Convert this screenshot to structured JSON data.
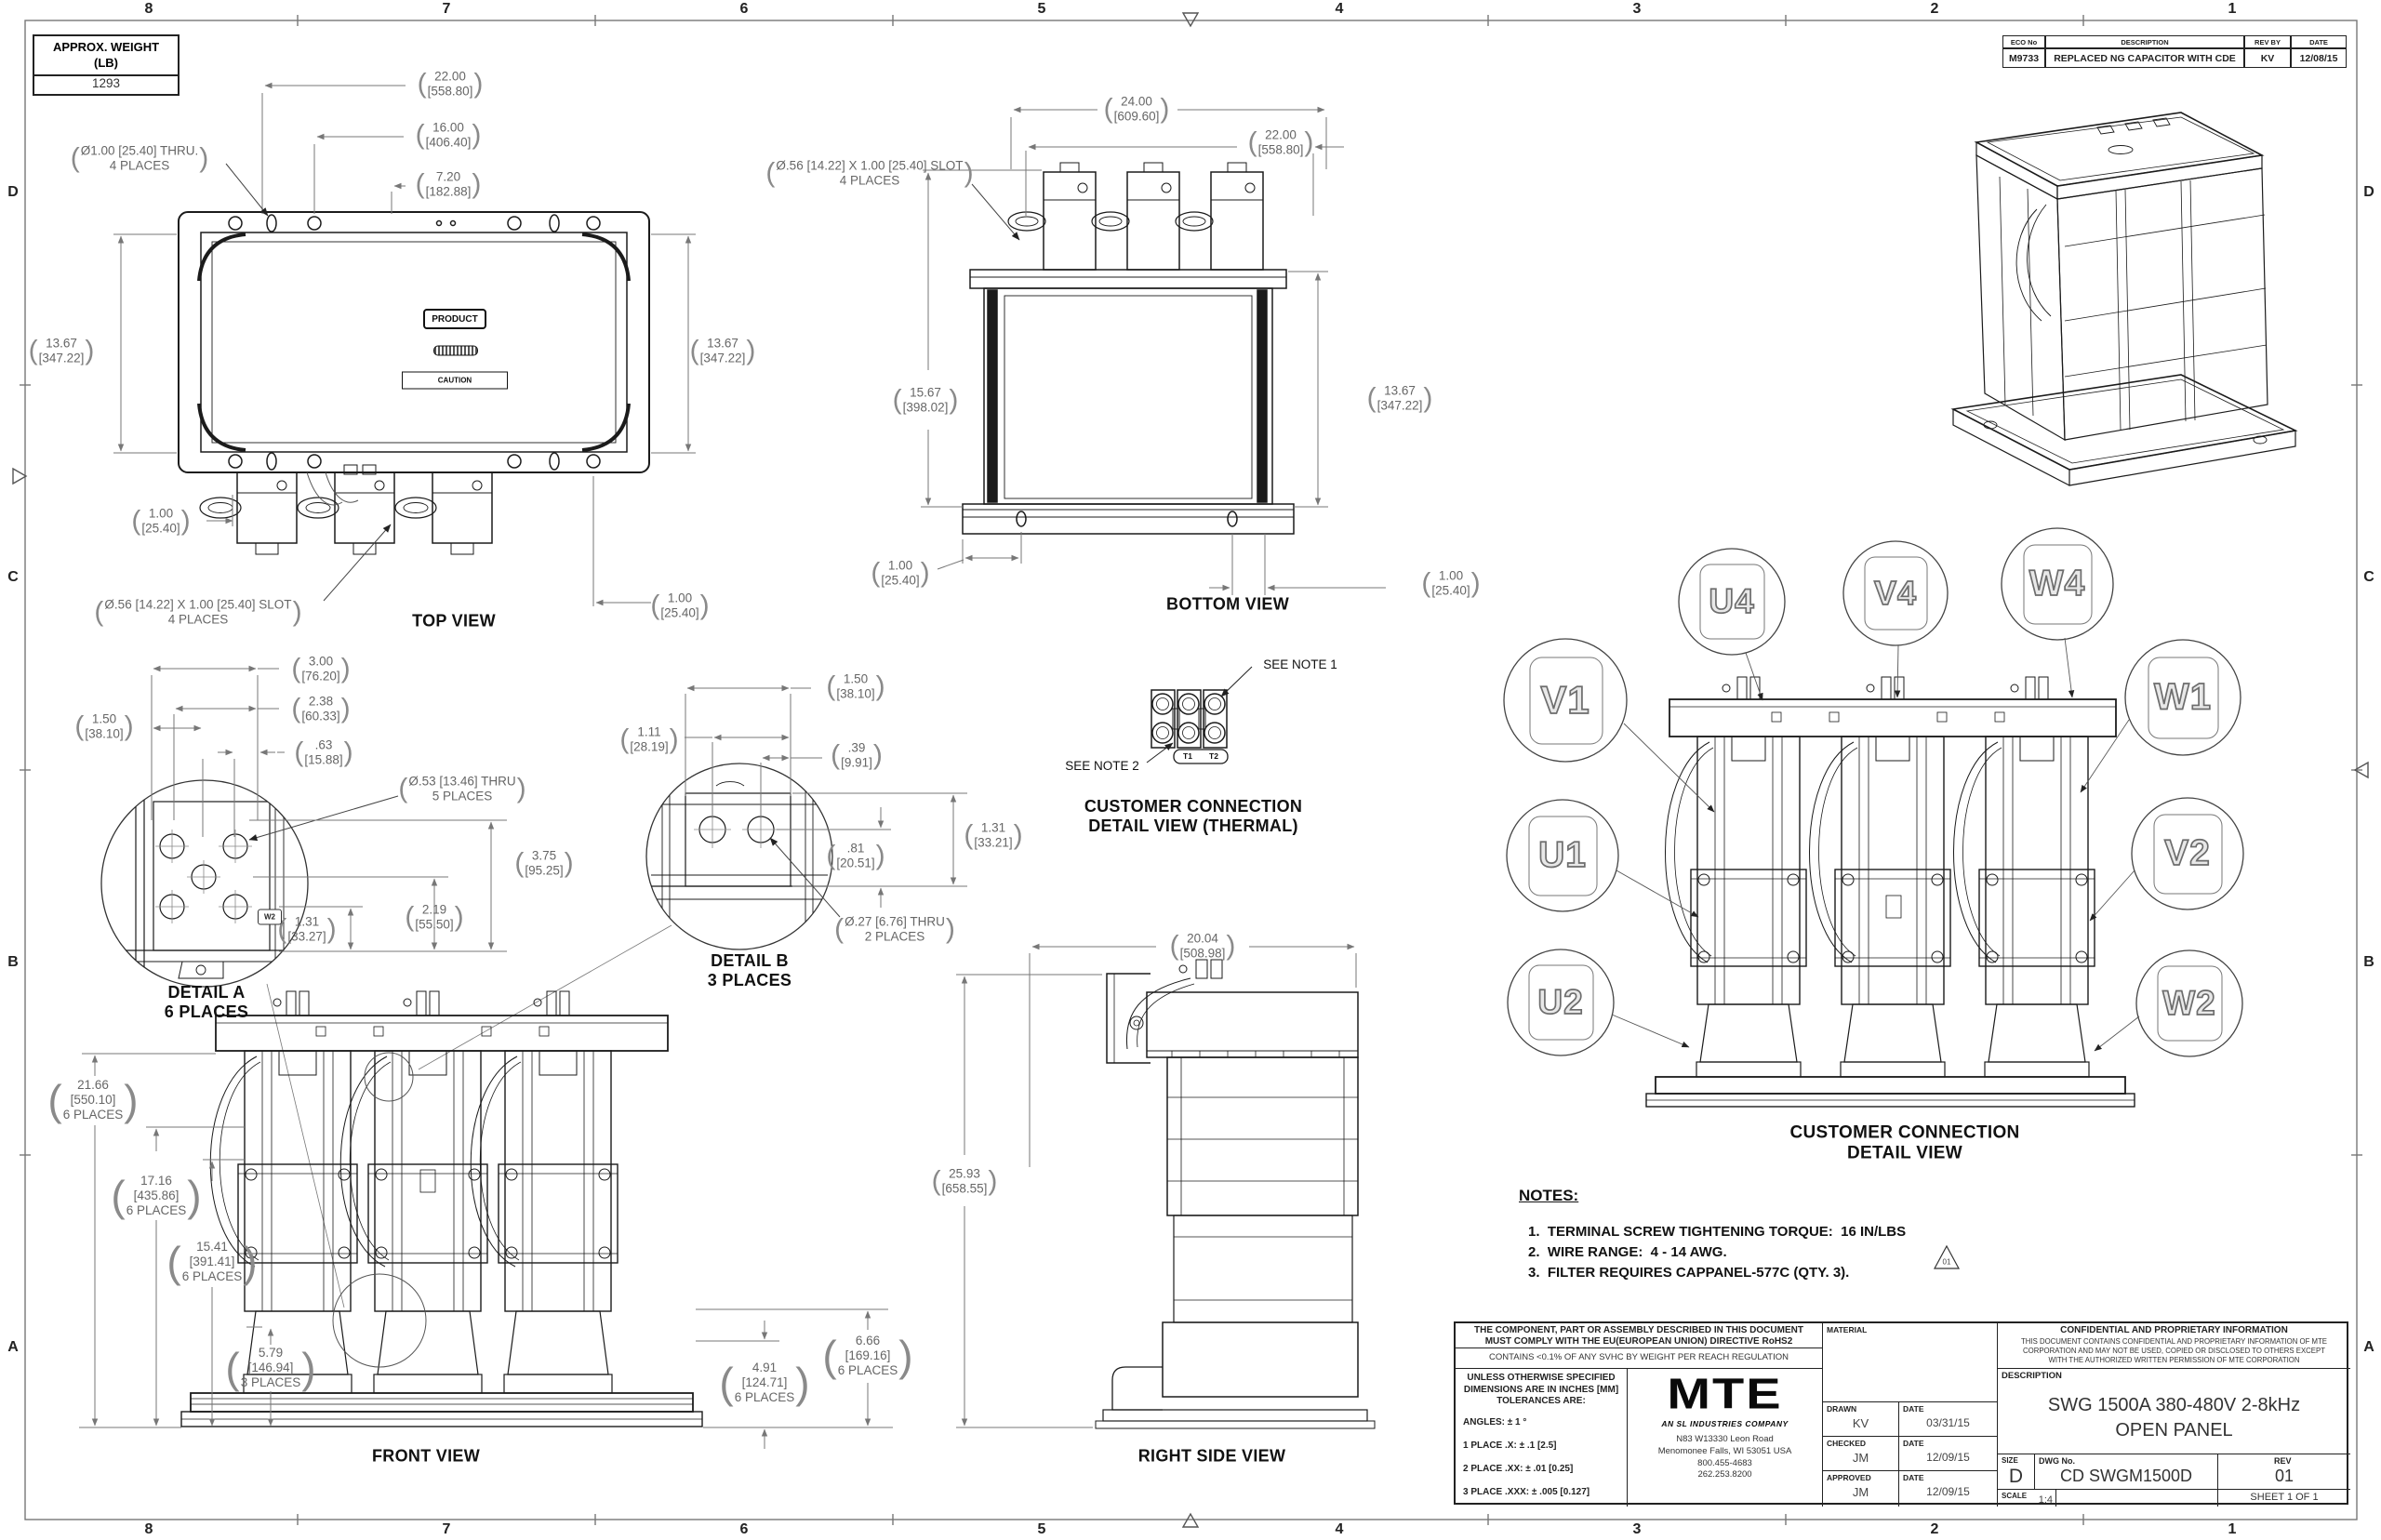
{
  "zones": {
    "columns": [
      "8",
      "7",
      "6",
      "5",
      "4",
      "3",
      "2",
      "1"
    ],
    "rows": [
      "D",
      "C",
      "B",
      "A"
    ]
  },
  "weight_box": {
    "label": "APPROX. WEIGHT\n(LB)",
    "value": "1293"
  },
  "eco_table": {
    "headers": [
      "ECO No",
      "DESCRIPTION",
      "REV BY",
      "DATE"
    ],
    "row": [
      "M9733",
      "REPLACED NG CAPACITOR WITH CDE",
      "KV",
      "12/08/15"
    ]
  },
  "views": {
    "top": {
      "title": "TOP VIEW",
      "product_label": "PRODUCT",
      "caution_label": "CAUTION",
      "dims": {
        "width": "22.00\n[558.80]",
        "width_inner": "16.00\n[406.40]",
        "width_small": "7.20\n[182.88]",
        "hole_note": "Ø1.00 [25.40] THRU.\n4 PLACES",
        "height_left": "13.67\n[347.22]",
        "height_right": "13.67\n[347.22]",
        "offset_left": "1.00\n[25.40]",
        "offset_right": "1.00\n[25.40]",
        "slot_note": "Ø.56 [14.22] X 1.00 [25.40] SLOT\n4 PLACES"
      }
    },
    "bottom": {
      "title": "BOTTOM VIEW",
      "dims": {
        "width": "24.00\n[609.60]",
        "width_inner": "22.00\n[558.80]",
        "slot_note": "Ø.56 [14.22] X 1.00 [25.40] SLOT\n4 PLACES",
        "height_left": "15.67\n[398.02]",
        "height_right": "13.67\n[347.22]",
        "offset_left": "1.00\n[25.40]",
        "offset_right": "1.00\n[25.40]"
      }
    },
    "detail_a": {
      "title": "DETAIL A\n6 PLACES",
      "tag": "W2",
      "dims": {
        "d1": "1.50\n[38.10]",
        "d2": "3.00\n[76.20]",
        "d3": "2.38\n[60.33]",
        "d4": ".63\n[15.88]",
        "hole_note": "Ø.53 [13.46] THRU\n5 PLACES",
        "d5": "3.75\n[95.25]",
        "d6": "2.19\n[55.50]",
        "d7": "1.31\n[33.27]"
      }
    },
    "detail_b": {
      "title": "DETAIL B\n3 PLACES",
      "dims": {
        "d1": "1.50\n[38.10]",
        "d2": "1.11\n[28.19]",
        "d3": ".39\n[9.91]",
        "d4": ".81\n[20.51]",
        "d5": "1.31\n[33.21]",
        "hole_note": "Ø.27 [6.76] THRU\n2 PLACES"
      }
    },
    "thermal": {
      "title": "CUSTOMER CONNECTION\nDETAIL VIEW (THERMAL)",
      "see_note_1": "SEE NOTE 1",
      "see_note_2": "SEE NOTE 2",
      "t1": "T1",
      "t2": "T2"
    },
    "front": {
      "title": "FRONT VIEW",
      "dims": {
        "h1": "21.66\n[550.10]\n6 PLACES",
        "h2": "17.16\n[435.86]\n6 PLACES",
        "h3": "15.41\n[391.41]\n6 PLACES",
        "h4": "5.79\n[146.94]\n3 PLACES",
        "h5": "4.91\n[124.71]\n6 PLACES",
        "h6": "6.66\n[169.16]\n6 PLACES"
      }
    },
    "right_side": {
      "title": "RIGHT SIDE VIEW",
      "dims": {
        "depth": "20.04\n[508.98]",
        "height": "25.93\n[658.55]"
      }
    },
    "connection": {
      "title": "CUSTOMER CONNECTION\nDETAIL VIEW",
      "terminals": [
        "V1",
        "U1",
        "U2",
        "U4",
        "V4",
        "W4",
        "W1",
        "V2",
        "W2"
      ]
    }
  },
  "notes": {
    "heading": "NOTES:",
    "items": [
      "1.  TERMINAL SCREW TIGHTENING TORQUE:  16 IN/LBS",
      "2.  WIRE RANGE:  4 - 14 AWG.",
      "3.  FILTER REQUIRES CAPPANEL-577C (QTY. 3)."
    ],
    "rev_flag": "01"
  },
  "title_block": {
    "compliance": "THE COMPONENT, PART OR ASSEMBLY DESCRIBED IN THIS DOCUMENT\nMUST COMPLY WITH THE EU(EUROPEAN UNION) DIRECTIVE RoHS2",
    "reach": "CONTAINS <0.1% OF ANY SVHC BY WEIGHT PER REACH REGULATION",
    "tolerances": {
      "heading": "UNLESS OTHERWISE SPECIFIED\nDIMENSIONS ARE IN INCHES [MM]\nTOLERANCES ARE:",
      "angles": "ANGLES: ± 1 °",
      "place1": "1 PLACE .X: ± .1 [2.5]",
      "place2": "2 PLACE .XX: ± .01 [0.25]",
      "place3": "3 PLACE .XXX: ± .005 [0.127]"
    },
    "logo": {
      "brand": "MTE",
      "tagline": "AN SL INDUSTRIES COMPANY",
      "address": "N83 W13330 Leon Road\nMenomonee Falls, WI 53051 USA\n800.455-4683\n262.253.8200"
    },
    "material_label": "MATERIAL",
    "signoff": [
      {
        "role": "DRAWN",
        "name": "KV",
        "date_label": "DATE",
        "date": "03/31/15"
      },
      {
        "role": "CHECKED",
        "name": "JM",
        "date_label": "DATE",
        "date": "12/09/15"
      },
      {
        "role": "APPROVED",
        "name": "JM",
        "date_label": "DATE",
        "date": "12/09/15"
      }
    ],
    "confidential": {
      "heading": "CONFIDENTIAL AND PROPRIETARY INFORMATION",
      "body": "THIS DOCUMENT CONTAINS CONFIDENTIAL AND PROPRIETARY INFORMATION OF MTE\nCORPORATION AND MAY NOT BE USED, COPIED OR DISCLOSED TO OTHERS EXCEPT\nWITH THE AUTHORIZED WRITTEN PERMISSION OF MTE CORPORATION"
    },
    "description_label": "DESCRIPTION",
    "description": "SWG 1500A 380-480V 2-8kHz\nOPEN PANEL",
    "size_label": "SIZE",
    "size": "D",
    "dwg_label": "DWG No.",
    "dwg_no": "CD SWGM1500D",
    "rev_label": "REV",
    "rev": "01",
    "scale_label": "SCALE",
    "scale": "1:4",
    "sheet": "SHEET 1  OF 1"
  }
}
